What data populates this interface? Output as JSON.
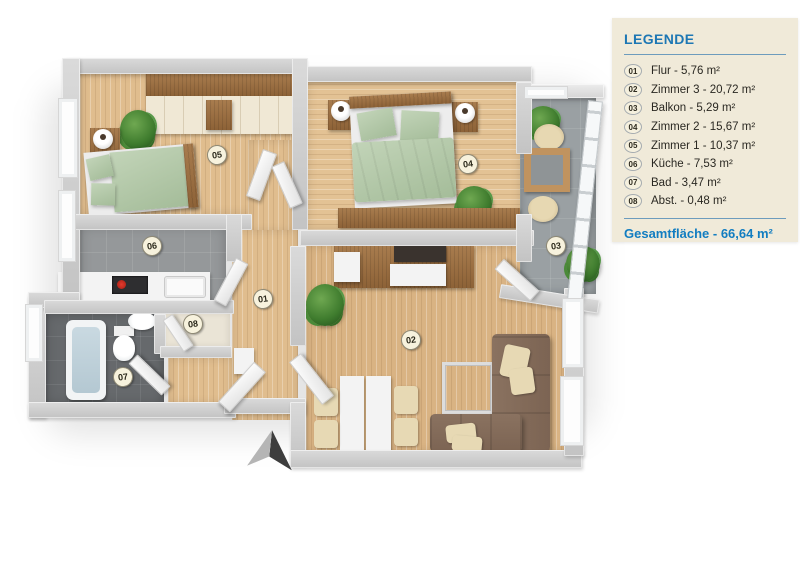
{
  "legend": {
    "title": "LEGENDE",
    "items": [
      {
        "num": "01",
        "label": "Flur - 5,76 m²"
      },
      {
        "num": "02",
        "label": "Zimmer 3 - 20,72 m²"
      },
      {
        "num": "03",
        "label": "Balkon - 5,29 m²"
      },
      {
        "num": "04",
        "label": "Zimmer 2 - 15,67 m²"
      },
      {
        "num": "05",
        "label": "Zimmer 1 - 10,37 m²"
      },
      {
        "num": "06",
        "label": "Küche - 7,53 m²"
      },
      {
        "num": "07",
        "label": "Bad - 3,47 m²"
      },
      {
        "num": "08",
        "label": "Abst. - 0,48 m²"
      }
    ],
    "total": "Gesamtfläche - 66,64 m²"
  },
  "plan": {
    "badges": [
      {
        "num": "05",
        "x": 217,
        "y": 155
      },
      {
        "num": "04",
        "x": 468,
        "y": 164
      },
      {
        "num": "03",
        "x": 556,
        "y": 246
      },
      {
        "num": "06",
        "x": 152,
        "y": 246
      },
      {
        "num": "01",
        "x": 263,
        "y": 299
      },
      {
        "num": "08",
        "x": 193,
        "y": 324
      },
      {
        "num": "02",
        "x": 411,
        "y": 340
      },
      {
        "num": "07",
        "x": 123,
        "y": 377
      }
    ]
  },
  "colors": {
    "legend_bg": "#f0ead9",
    "accent_blue": "#1d77b4",
    "total_blue": "#117dc1",
    "badge_bg": "#f7f2dd",
    "wood_floor": "#e0bd8e",
    "tile_gray": "#95989a",
    "tile_dark": "#66696c",
    "bedding_green": "#b5c9ab",
    "sofa_brown": "#8a7260"
  }
}
